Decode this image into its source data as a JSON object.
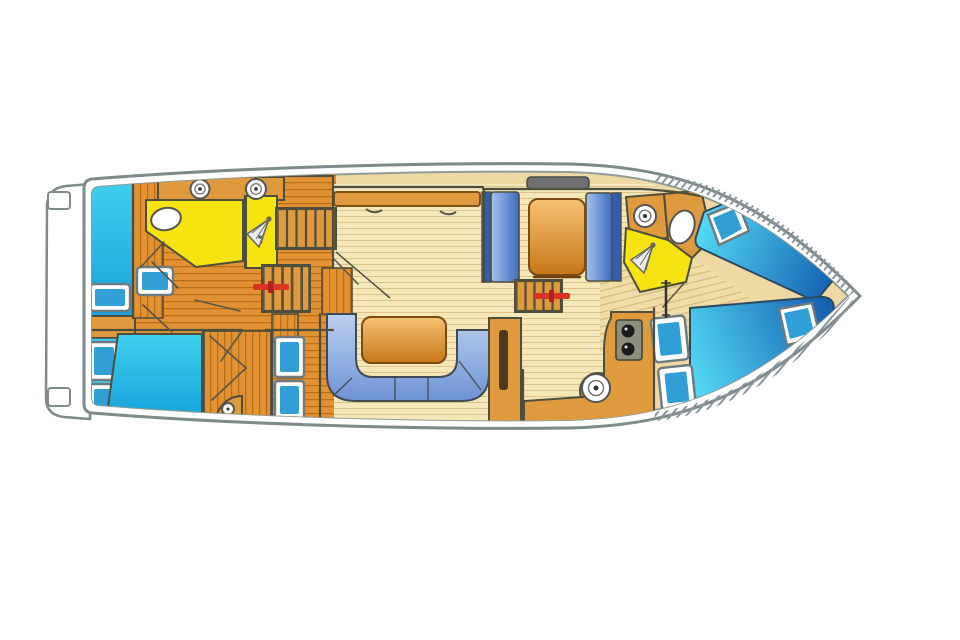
{
  "figure": {
    "kind": "boat-floor-plan",
    "view": "top-down interior deck plan, bow pointing right, swim platform at stern (left)"
  },
  "palette": {
    "pageBg": "#ffffff",
    "white": "#ffffff",
    "hullStroke": "#7e8a8c",
    "hullInnerStroke": "#909c97",
    "deckTan": "#eed9a4",
    "plankOrange": "#e29233",
    "plankOrangeLine": "#b96f16",
    "plankLight": "#f6e7b9",
    "plankLightLine": "#dcc28b",
    "soleTan": "#f0dca6",
    "soleLine": "#d6b87e",
    "wall": "#4e4e3f",
    "doorLine": "#5c5744",
    "yellow": "#f6e411",
    "counterOrange": "#e09a3e",
    "counterEdge": "#7a5215",
    "stairGap": "#8a6a28",
    "stairStep": "#e09a3e",
    "tableTop": "#f6c273",
    "tableBottom": "#c67716",
    "bedCyanLight": "#40cfee",
    "bedCyanDeep": "#14a0da",
    "berthLight": "#52d6f2",
    "berthDeep": "#1460b2",
    "benchLight": "#a3c2ec",
    "benchDeep": "#3f6cc0",
    "benchBack": "#2f5fb4",
    "sofaLight": "#bcd0ee",
    "sofaDeep": "#6e93d4",
    "cushionBlue": "#2f9fd6",
    "frameStroke": "#6d7a7e",
    "fixtureStroke": "#555555",
    "red": "#d93425",
    "redDark": "#b01f1a",
    "windowGray": "#707070",
    "stoveGray": "#8e8e7c",
    "black": "#1b1b1b",
    "hatch": "#8b9499",
    "slotDark": "#4a3a20"
  },
  "icons": {
    "sink": "circle-with-inner-ring",
    "shower-head": "spray-fan-triangle",
    "toilet": "oval-bowl",
    "stove": "panel-with-two-burners",
    "stairs": "ladder-rungs",
    "entry-marker": "red-bar-with-tick",
    "grab-pole": "thin-vertical-rod",
    "cleat": "small-rounded-rect"
  }
}
